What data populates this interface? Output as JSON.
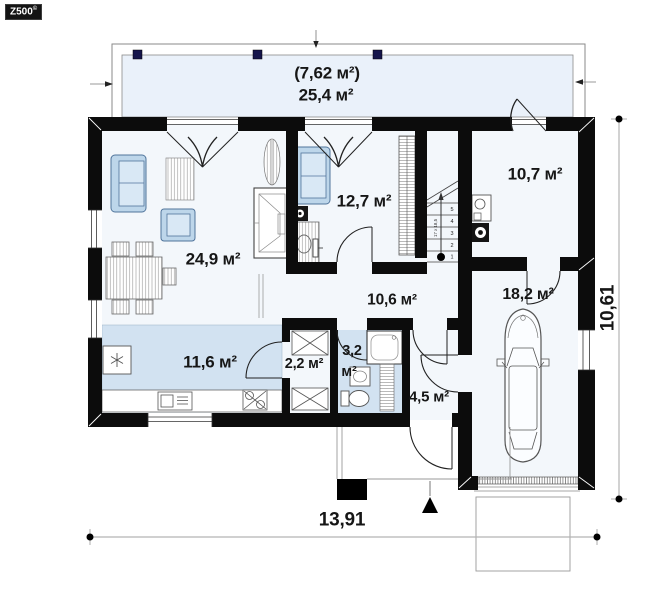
{
  "logo": {
    "text": "Z500",
    "mark": "©"
  },
  "plan": {
    "rooms": [
      {
        "id": "terrace",
        "note": "(7,62 м²)",
        "area": "25,4 м²"
      },
      {
        "id": "living-room",
        "area": "24,9 м²"
      },
      {
        "id": "room-12",
        "area": "12,7 м²"
      },
      {
        "id": "room-10",
        "area": "10,7 м²"
      },
      {
        "id": "hall",
        "area": "10,6 м²"
      },
      {
        "id": "kitchen",
        "area": "11,6 м²"
      },
      {
        "id": "pantry",
        "area": "2,2 м²"
      },
      {
        "id": "bathroom",
        "area_value": "3,2",
        "area_unit": "м²"
      },
      {
        "id": "vestibule",
        "area": "4,5 м²"
      },
      {
        "id": "garage",
        "area": "18,2 м²"
      }
    ],
    "dimensions": {
      "width": "13,91",
      "height": "10,61"
    },
    "stairs": {
      "steps": [
        "1",
        "2",
        "3",
        "4",
        "5"
      ],
      "note": "17 x 18,5"
    },
    "colors": {
      "wall": "#0c0c0c",
      "room_fill": "#f3f7fb",
      "accent_fill": "#d2e2f1",
      "terrace_fill": "#eaf1fa",
      "furniture_blue": "#bdd6ea",
      "column_navy": "#15154a"
    }
  }
}
